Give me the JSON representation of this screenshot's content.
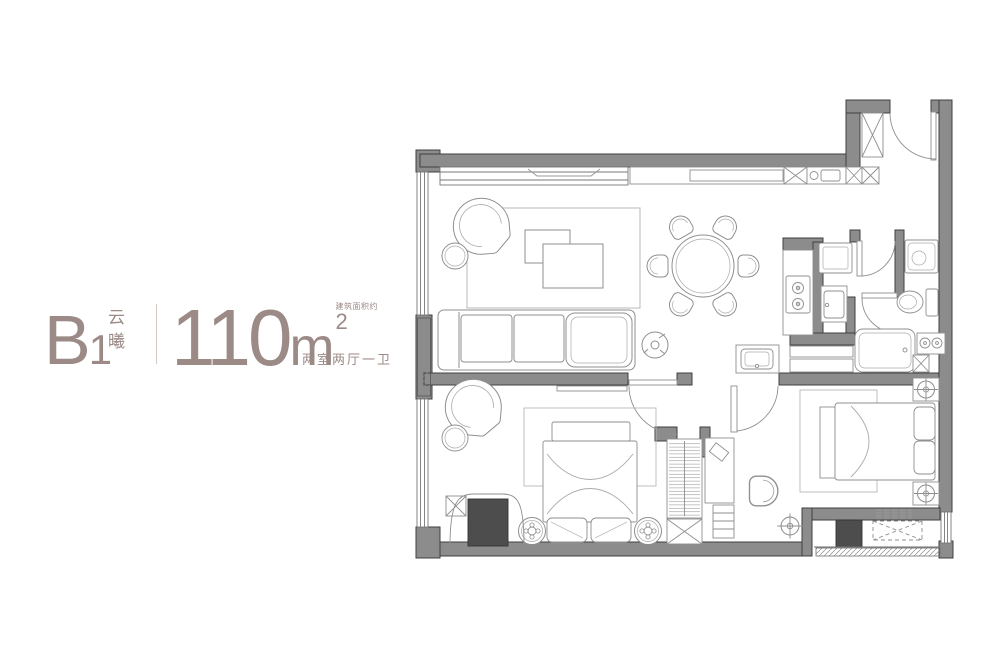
{
  "title_block": {
    "unit_letter": "B",
    "unit_number": "1",
    "project_name_chars": [
      "云",
      "曦"
    ],
    "area_value": "110",
    "area_unit": "m",
    "area_exponent": "2",
    "area_note": "建筑面积约",
    "layout_summary": "两室两厅一卫",
    "text_color": "#9b8a86",
    "divider_color": "#d3c8c4"
  },
  "floor_plan": {
    "wall_color": "#8c8c8c",
    "wall_edge_color": "#3f3f3f",
    "furniture_line_color": "#8f8f8f",
    "rug_line_color": "#b8b8b8",
    "dark_fixture_color": "#4d4d4d",
    "background": "#ffffff"
  }
}
